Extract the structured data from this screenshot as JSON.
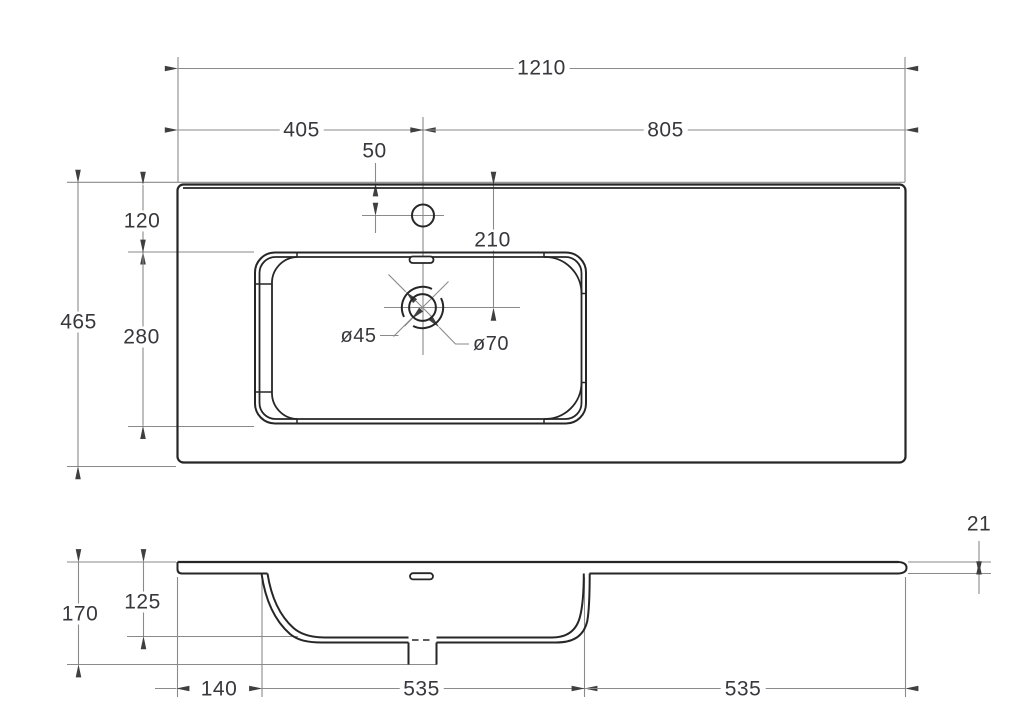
{
  "drawing_type": "washbasin-countertop-dimension-drawing",
  "top_view": {
    "dims": {
      "overall_width": "1210",
      "faucet_center_from_left": "405",
      "faucet_center_from_right": "805",
      "faucet_from_back_edge": "50",
      "basin_from_back_edge": "120",
      "drain_center_from_back_edge": "210",
      "overall_depth": "465",
      "basin_depth": "280",
      "drain_hole_diameter": "ø45",
      "drain_flange_diameter": "ø70"
    }
  },
  "section_view": {
    "dims": {
      "countertop_thickness": "21",
      "basin_inner_depth": "125",
      "overall_height": "170",
      "basin_left_offset": "140",
      "basin_width": "535",
      "right_ledge_width": "535"
    }
  },
  "colors": {
    "background": "#ffffff",
    "object_line": "#262626",
    "dimension_line": "#8a8a8a",
    "arrow": "#3f3f3f",
    "text": "#37373c"
  }
}
